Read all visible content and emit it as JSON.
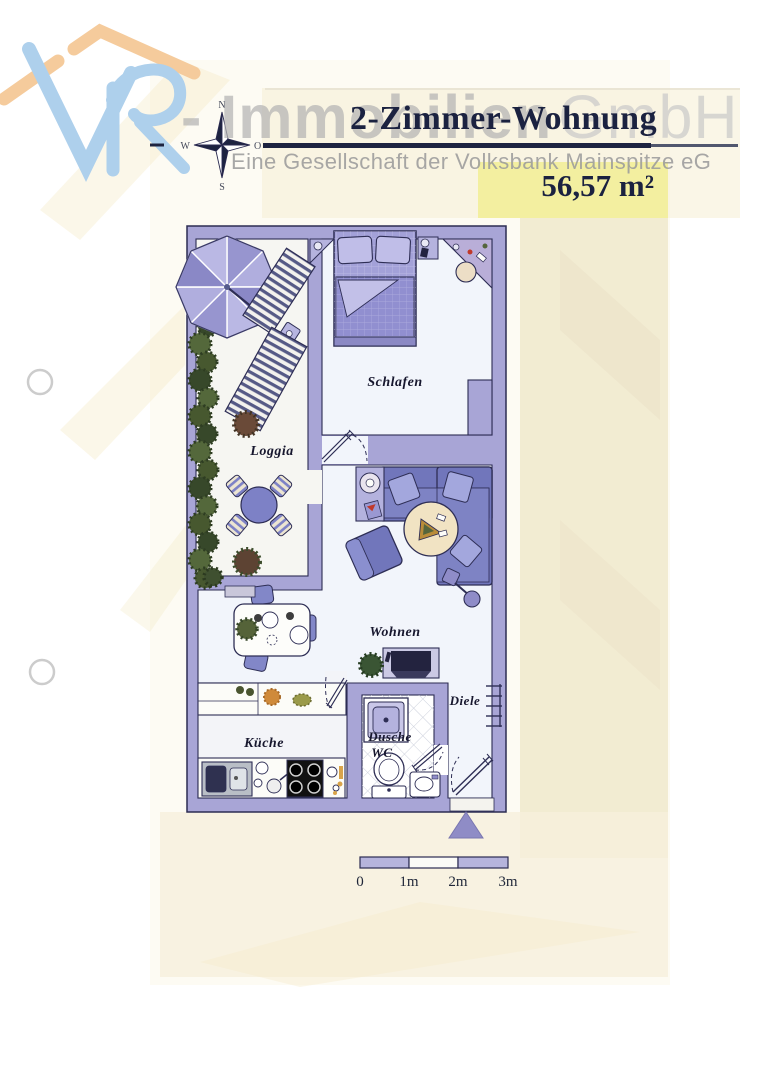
{
  "document": {
    "watermark_prefix": "- Immobilien",
    "watermark_suffix": "GmbH",
    "title": "2-Zimmer-Wohnung",
    "subtitle": "Eine Gesellschaft der Volksbank Mainspitze eG",
    "area_label": "56,57 m²"
  },
  "compass": {
    "north": "N",
    "east": "O",
    "south": "S",
    "west": "W"
  },
  "floor_plan": {
    "rooms": {
      "schlafen": "Schlafen",
      "loggia": "Loggia",
      "wohnen": "Wohnen",
      "kueche": "Küche",
      "dusche_line1": "Dusche",
      "dusche_line2": "WC",
      "diele": "Diele"
    }
  },
  "scale_bar": {
    "tick_labels": [
      "0",
      "1m",
      "2m",
      "3m"
    ]
  },
  "colors": {
    "wall": "#a8a5d6",
    "navy_accent": "#1d2340",
    "highlight_yellow": "#f3efa0",
    "furniture_blue": "#7176bb",
    "logo_roof_orange": "#f5cb9c",
    "logo_letters_blue": "#aed0ec"
  },
  "icons": [
    "vr-logo-roof-icon",
    "vr-logo-letters-icon",
    "compass-rose-icon",
    "umbrella-icon",
    "sun-lounger-icon",
    "hedge-icon",
    "plant-icon",
    "bed-icon",
    "vanity-icon",
    "sofa-icon",
    "armchair-icon",
    "coffee-table-icon",
    "side-table-icon",
    "floor-lamp-icon",
    "dining-table-icon",
    "dining-chair-icon",
    "tv-cabinet-icon",
    "kitchen-counter-icon",
    "kitchen-sink-icon",
    "stove-icon",
    "shower-icon",
    "toilet-icon",
    "bath-sink-icon",
    "radiator-icon",
    "door-icon",
    "entrance-marker-icon",
    "scale-bar",
    "punch-hole-icon"
  ]
}
